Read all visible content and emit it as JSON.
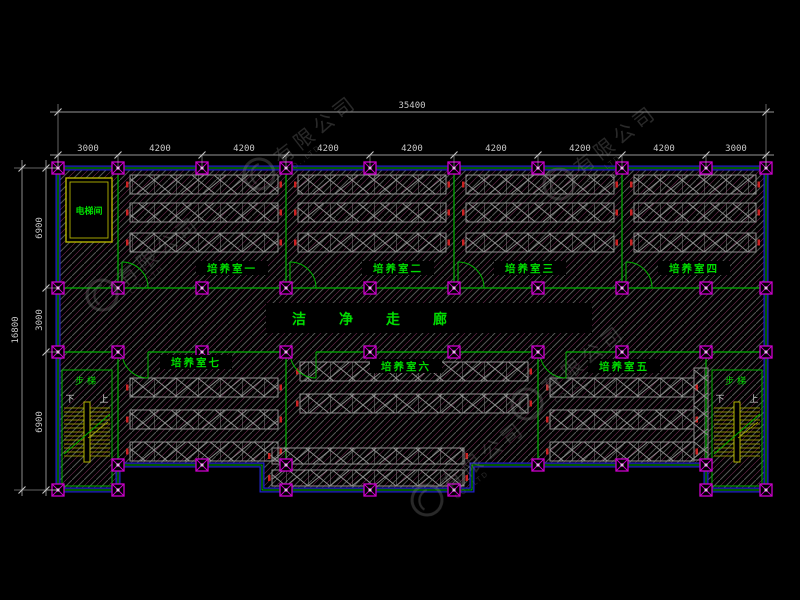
{
  "drawing": {
    "type": "floor-plan",
    "description": "CAD floor plan, cultivation rooms with clean corridor"
  },
  "dimensions": {
    "top": {
      "total": "35400",
      "segments": [
        "3000",
        "4200",
        "4200",
        "4200",
        "4200",
        "4200",
        "4200",
        "4200",
        "3000"
      ]
    },
    "left": {
      "total": "16800",
      "segments": [
        "6900",
        "3000",
        "6900"
      ]
    }
  },
  "room_labels": [
    "培养室一",
    "培养室二",
    "培养室三",
    "培养室四",
    "培养室五",
    "培养室六",
    "培养室七"
  ],
  "labels": {
    "corridor": "洁净走廊",
    "elevator": "电梯间",
    "stairs": "步梯",
    "up": "上",
    "down": "下"
  },
  "watermark": {
    "cn": "有限公司",
    "en": "CO.,LTD"
  },
  "colors": {
    "background": "#000000",
    "wall_blue": "#2222cc",
    "line_green": "#00b400",
    "label_green": "#00dd00",
    "dim_gray": "#c8c8c8",
    "column_magenta": "#cc00cc",
    "stair_yellow": "#b4b400",
    "rack_gray": "#8f8f8f",
    "hatch_gray": "#565656",
    "hatch_magenta": "#6b2c50",
    "red_accent": "#cc2222",
    "watermark_gray": "#8a8a8a"
  }
}
